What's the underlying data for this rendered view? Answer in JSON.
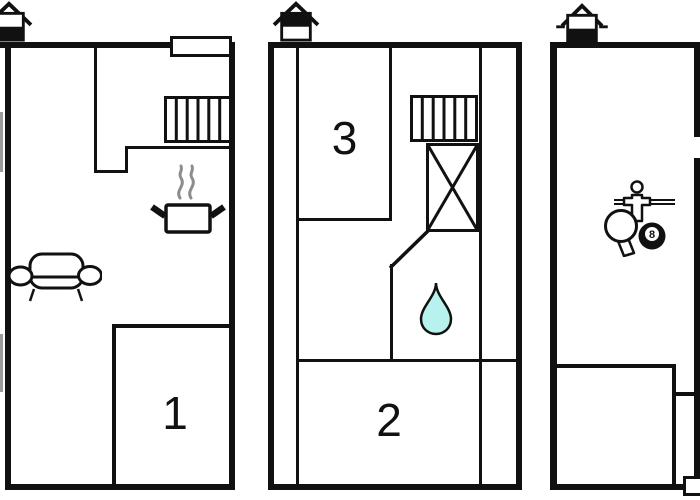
{
  "document": "three-level-floor-plan",
  "colors": {
    "wall": "#111111",
    "background": "#ffffff",
    "water_drop": "#b7f2ee",
    "steam": "#8c8c8c",
    "window_marker": "#9b9b9b"
  },
  "plans": [
    {
      "name": "ground-floor",
      "level_icon": "house-level-ground-icon",
      "rooms": [
        {
          "label": "1"
        }
      ],
      "features": [
        "stairs-icon",
        "cooking-pot-icon",
        "sofa-icon",
        "window-marker"
      ]
    },
    {
      "name": "first-floor",
      "level_icon": "house-level-first-icon",
      "rooms": [
        {
          "label": "3"
        },
        {
          "label": "2"
        }
      ],
      "features": [
        "stairs-icon",
        "crossed-box-icon",
        "water-drop-icon"
      ]
    },
    {
      "name": "basement",
      "level_icon": "house-level-basement-icon",
      "rooms": [],
      "features": [
        "foosball-icon",
        "table-tennis-icon",
        "billiard-ball-icon"
      ],
      "ball_label": "8"
    }
  ]
}
